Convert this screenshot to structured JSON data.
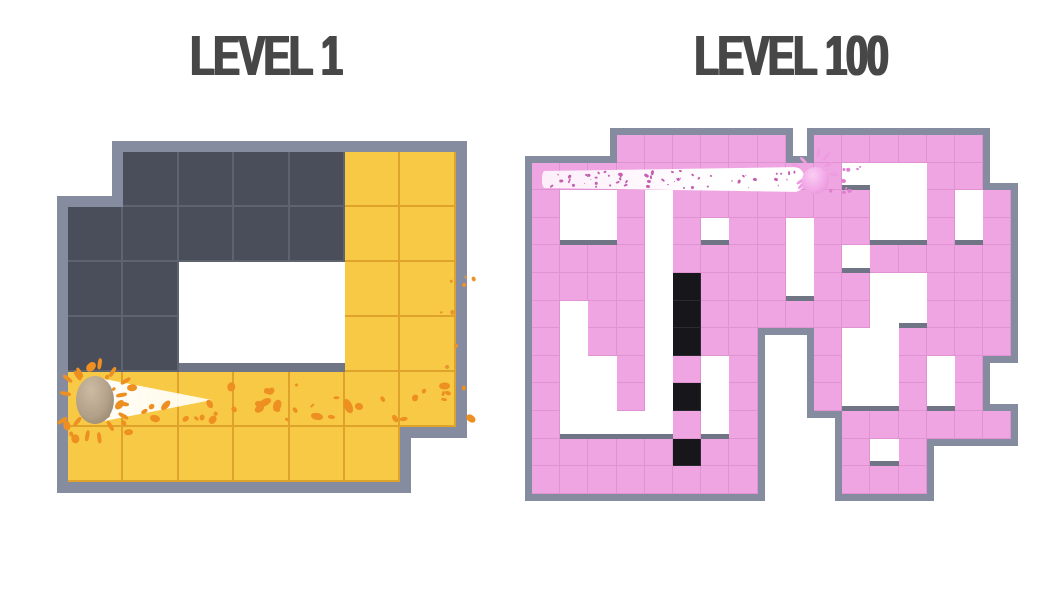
{
  "titles": {
    "left": "LEVEL 1",
    "right": "LEVEL 100"
  },
  "title_color": "#474747",
  "left_maze": {
    "label": "level-1-board",
    "origin": {
      "x": 68,
      "y": 152
    },
    "cell": {
      "w": 55.4,
      "h": 55
    },
    "border": 11,
    "strip": 9,
    "line_w": 2,
    "legend": {
      "D": "unpainted-dark-tile",
      "Y": "painted-yellow-tile",
      "W": "hole",
      ".": "outside"
    },
    "grid": [
      ".DDDDYY",
      "DDDDDYY",
      "DDWWWYY",
      "DDWWWYY",
      "YYYYYYY",
      "YYYYYY."
    ],
    "palette": {
      "D": {
        "bg": "#4A4E5A",
        "line": "#5E6370"
      },
      "Y": {
        "bg": "#F7C945",
        "line": "#DFA32C"
      }
    },
    "border_color": "#868CA0",
    "strip_color": "#6F7585",
    "ball": {
      "cx": 95,
      "cy": 400,
      "rx": 19,
      "ry": 24,
      "hi": "#CDBCA4",
      "mid": "#B2A088",
      "lo": "#8A7A66"
    },
    "trail": {
      "type": "cone",
      "x": 100,
      "y": 374,
      "w": 112,
      "h": 52
    },
    "spikes": {
      "seed": 21,
      "count": 15,
      "cx": 95,
      "cy": 400,
      "r1": 26,
      "r2": 40,
      "len": 11,
      "wd": 3.6,
      "color": "#ED8F21"
    },
    "splats": [
      {
        "seed": 7,
        "count": 42,
        "x": 108,
        "y": 382,
        "w": 360,
        "h": 36,
        "rmin": 1.2,
        "rmax": 4,
        "stretch": 2.1,
        "color": "#ED8F21"
      },
      {
        "seed": 3,
        "count": 14,
        "x": 58,
        "y": 360,
        "w": 72,
        "h": 78,
        "rmin": 1.5,
        "rmax": 4.2,
        "stretch": 1.6,
        "color": "#ED8F21"
      },
      {
        "seed": 11,
        "count": 8,
        "x": 438,
        "y": 272,
        "w": 34,
        "h": 108,
        "rmin": 1,
        "rmax": 2.4,
        "stretch": 1.3,
        "color": "#E8952E"
      }
    ]
  },
  "right_maze": {
    "label": "level-100-board",
    "origin": {
      "x": 532,
      "y": 135
    },
    "cell": {
      "w": 28.2,
      "h": 27.6
    },
    "border": 7,
    "strip": 5,
    "line_w": 1,
    "legend": {
      "P": "painted-pink-tile",
      "K": "unpainted-black-tile",
      "W": "hole",
      ".": "outside"
    },
    "grid": [
      "...PPPPPP.PPPPPP.",
      "PPPPPPPPPPPWWWPP.",
      "PWWPWPPPPPPPWWPWP",
      "PWWPWPWPPWPPWWPWP",
      "PPPPWPPPPWPWPPPPP",
      "PPPPWKPPPWPPWWPPP",
      "PWPPWKPPPPPPWWPPP",
      "PWPPWKPP..PWWPPPP",
      "PWWPWPWP..PWWPWP.",
      "PWWPWKWP..PWWPWP.",
      "PWWWWPWP...PPPPPP",
      "PPPPPKPP...PWP...",
      "PPPPPPPP...PPP..."
    ],
    "palette": {
      "P": {
        "bg": "#F0A5E3",
        "line": "#E192D2"
      },
      "K": {
        "bg": "#17171B",
        "line": "#2A2A31"
      }
    },
    "border_color": "#868CA0",
    "strip_color": "#6F7585",
    "ball": {
      "cx": 815,
      "cy": 180,
      "rx": 13.5,
      "ry": 13.5,
      "hi": "#FACDF3",
      "mid": "#F2A8E7",
      "lo": "#DF8BD0"
    },
    "trail": {
      "type": "band",
      "x": 542,
      "y": 167,
      "w": 262,
      "h": 25
    },
    "spikes": {
      "seed": 13,
      "count": 10,
      "cx": 815,
      "cy": 172,
      "r1": 14,
      "r2": 24,
      "len": 9,
      "wd": 3,
      "color": "#EE9BDF"
    },
    "splats": [
      {
        "seed": 5,
        "count": 60,
        "x": 548,
        "y": 170,
        "w": 252,
        "h": 17,
        "rmin": 0.5,
        "rmax": 1.6,
        "stretch": 1.8,
        "color": "#C45FB2"
      },
      {
        "seed": 9,
        "count": 9,
        "x": 828,
        "y": 166,
        "w": 32,
        "h": 28,
        "rmin": 0.8,
        "rmax": 2,
        "stretch": 1.4,
        "color": "#E07ED0"
      }
    ]
  }
}
